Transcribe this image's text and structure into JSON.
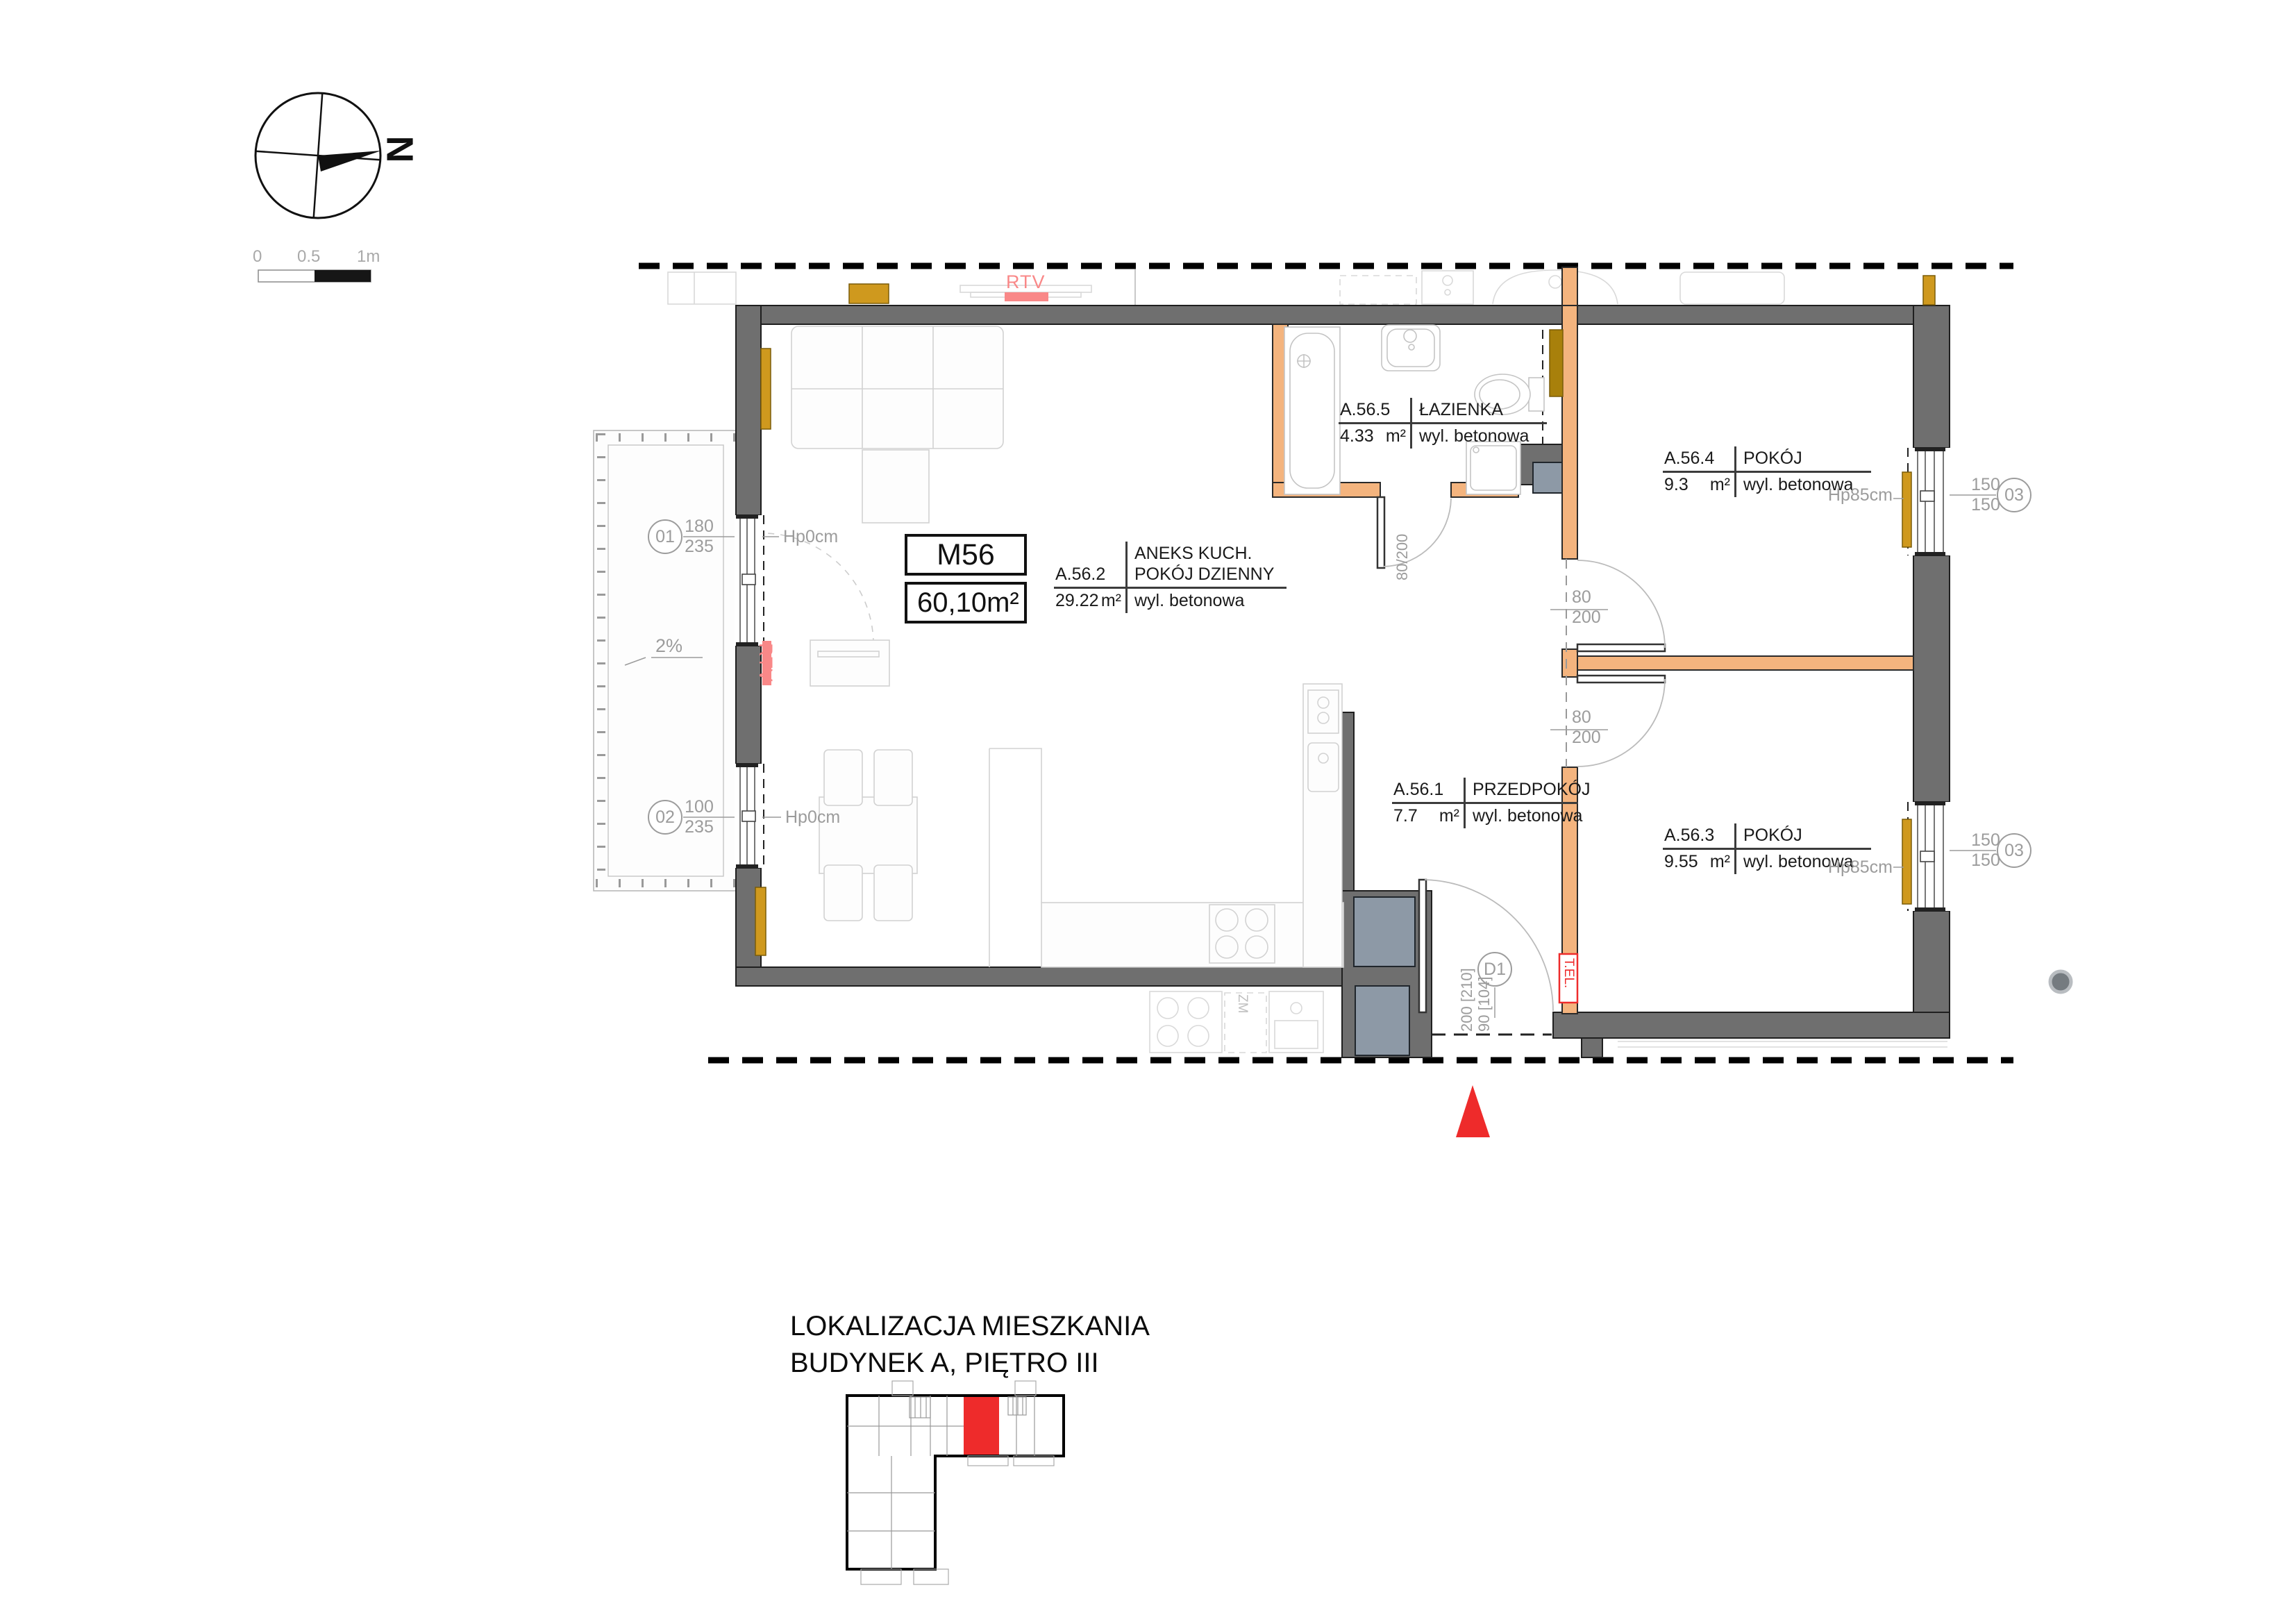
{
  "colors": {
    "wall": "#6f6f6f",
    "wall_edge": "#1f1f1f",
    "partition": "#f4b47e",
    "partition_edge": "#2a2a2a",
    "radiator": "#cf991e",
    "radiator_dark": "#a8800b",
    "shaft": "#8d99a6",
    "red": "#ee2b2b",
    "soft_red": "#f98888",
    "dim": "#9c9c9c",
    "faint": "#d9d9d9"
  },
  "compass": {
    "letter": "N"
  },
  "scale_bar": {
    "t0": "0",
    "t1": "0.5",
    "t2": "1m"
  },
  "unit_card": {
    "code": "M56",
    "area": "60,10",
    "unit": "m²"
  },
  "rooms": [
    {
      "id": "A.56.1",
      "name1": "PRZEDPOKÓJ",
      "name2": "",
      "area": "7.7",
      "unit": "m²",
      "floor": "wyl. betonowa"
    },
    {
      "id": "A.56.2",
      "name1": "ANEKS KUCH.",
      "name2": "POKÓJ DZIENNY",
      "area": "29.22",
      "unit": "m²",
      "floor": "wyl. betonowa"
    },
    {
      "id": "A.56.3",
      "name1": "POKÓJ",
      "name2": "",
      "area": "9.55",
      "unit": "m²",
      "floor": "wyl. betonowa"
    },
    {
      "id": "A.56.4",
      "name1": "POKÓJ",
      "name2": "",
      "area": "9.3",
      "unit": "m²",
      "floor": "wyl. betonowa"
    },
    {
      "id": "A.56.5",
      "name1": "ŁAZIENKA",
      "name2": "",
      "area": "4.33",
      "unit": "m²",
      "floor": "wyl. betonowa"
    }
  ],
  "windows": {
    "w01": {
      "id": "01",
      "w": "180",
      "h": "235",
      "sill": "Hp0cm"
    },
    "w02": {
      "id": "02",
      "w": "100",
      "h": "235",
      "sill": "Hp0cm"
    },
    "w03a": {
      "id": "03",
      "w": "150",
      "h": "150",
      "sill": "Hp85cm"
    },
    "w03b": {
      "id": "03",
      "w": "150",
      "h": "150",
      "sill": "Hp85cm"
    }
  },
  "doors": {
    "room_top": {
      "w": "80",
      "h": "200"
    },
    "room_bottom": {
      "w": "80",
      "h": "200"
    },
    "bath": {
      "dim": "80/200"
    },
    "entry": {
      "code": "D1",
      "line1": "200 [210]",
      "line2": "90 [104]"
    }
  },
  "annotations": {
    "rtv_top": "RTV",
    "rtv_left": "RTV",
    "tel": "T.EL.",
    "slope": "2%",
    "dishwasher": "ZM"
  },
  "location": {
    "line1": "LOKALIZACJA MIESZKANIA",
    "line2": "BUDYNEK A, PIĘTRO III"
  }
}
